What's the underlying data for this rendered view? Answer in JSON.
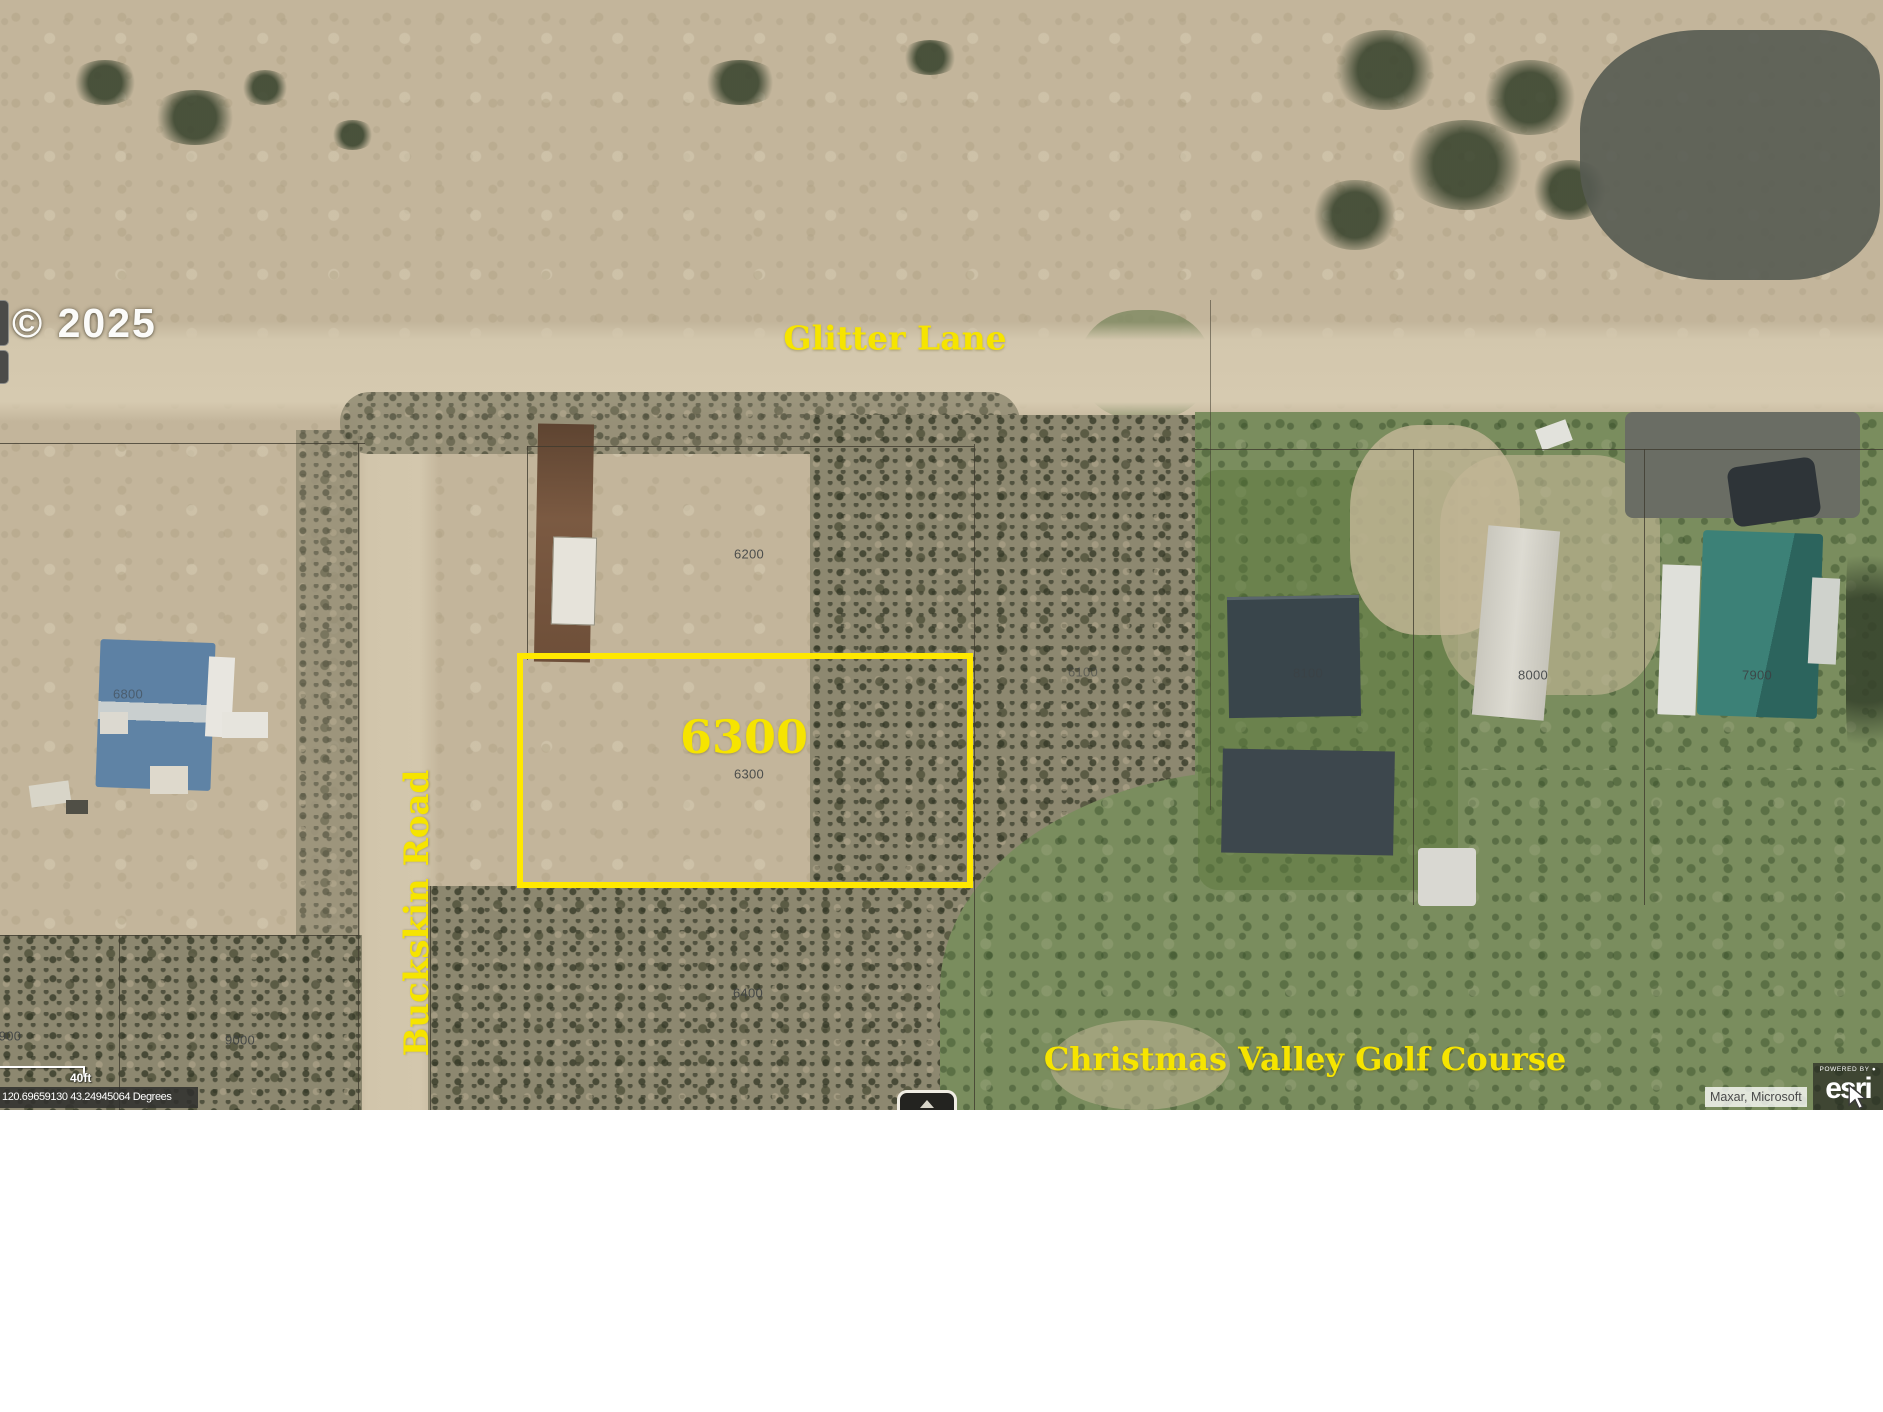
{
  "map": {
    "copyright": "© 2025",
    "road_labels": [
      {
        "id": "glitter-lane",
        "label": "Glitter Lane"
      },
      {
        "id": "buckskin-road",
        "label": "Buckskin Road"
      }
    ],
    "golf_course_label": "Christmas Valley Golf Course",
    "highlighted_parcel": {
      "label": "6300",
      "border_color": "#ffe800"
    },
    "parcel_labels": [
      {
        "id": "6200",
        "label": "6200",
        "x": 749,
        "y": 554,
        "dim": false
      },
      {
        "id": "6300",
        "label": "6300",
        "x": 749,
        "y": 774,
        "dim": false
      },
      {
        "id": "6400",
        "label": "6400",
        "x": 748,
        "y": 993,
        "dim": false
      },
      {
        "id": "6100",
        "label": "6100",
        "x": 1083,
        "y": 672,
        "dim": true
      },
      {
        "id": "8100",
        "label": "8100",
        "x": 1308,
        "y": 673,
        "dim": true
      },
      {
        "id": "8000",
        "label": "8000",
        "x": 1533,
        "y": 675,
        "dim": false
      },
      {
        "id": "7900",
        "label": "7900",
        "x": 1757,
        "y": 675,
        "dim": false
      },
      {
        "id": "6800",
        "label": "6800",
        "x": 128,
        "y": 694,
        "dim": true
      },
      {
        "id": "900",
        "label": "900",
        "x": 10,
        "y": 1036,
        "dim": false
      },
      {
        "id": "9000",
        "label": "9000",
        "x": 240,
        "y": 1040,
        "dim": false
      }
    ],
    "scale_bar": {
      "label": "40ft"
    },
    "coordinate_readout": "120.69659130 43.24945064 Degrees",
    "attribution": {
      "sources": "Maxar, Microsoft",
      "powered_by": "POWERED BY",
      "brand": "esri"
    },
    "colors": {
      "annotation_yellow": "#f6e400",
      "highlight_border": "#ffe800"
    }
  }
}
